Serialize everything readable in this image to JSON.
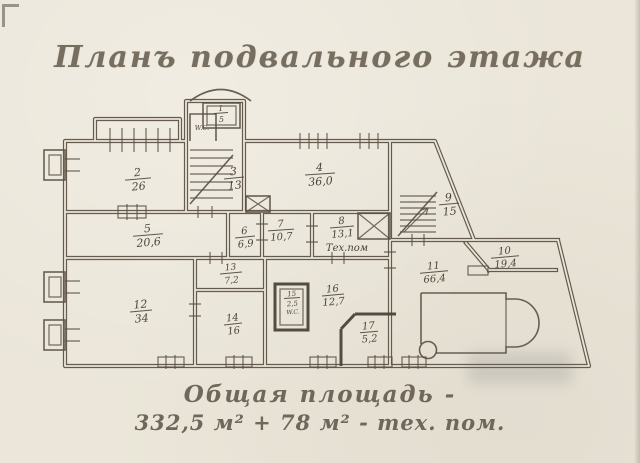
{
  "page": {
    "title": "Планъ подвального этажа",
    "caption_line1": "Общая площадь -",
    "caption_line2": "332,5 м² + 78 м² - тех. пом."
  },
  "colors": {
    "paper": "#ebe6d9",
    "ink": "#554b3f",
    "title_text": "#776e5f"
  },
  "labels": {
    "wc": "W.C.",
    "tech": "Тех.пом"
  },
  "rooms": [
    {
      "number": "1",
      "area": "5"
    },
    {
      "number": "2",
      "area": "26"
    },
    {
      "number": "3",
      "area": "13"
    },
    {
      "number": "4",
      "area": "36,0"
    },
    {
      "number": "5",
      "area": "20,6"
    },
    {
      "number": "6",
      "area": "6,9"
    },
    {
      "number": "7",
      "area": "10,7"
    },
    {
      "number": "8",
      "area": "13,1"
    },
    {
      "number": "9",
      "area": "15"
    },
    {
      "number": "10",
      "area": "19,4"
    },
    {
      "number": "11",
      "area": "66,4"
    },
    {
      "number": "12",
      "area": "34"
    },
    {
      "number": "13",
      "area": "7,2"
    },
    {
      "number": "14",
      "area": "16"
    },
    {
      "number": "15",
      "area": "2,5"
    },
    {
      "number": "16",
      "area": "12,7"
    },
    {
      "number": "17",
      "area": "5,2"
    }
  ]
}
